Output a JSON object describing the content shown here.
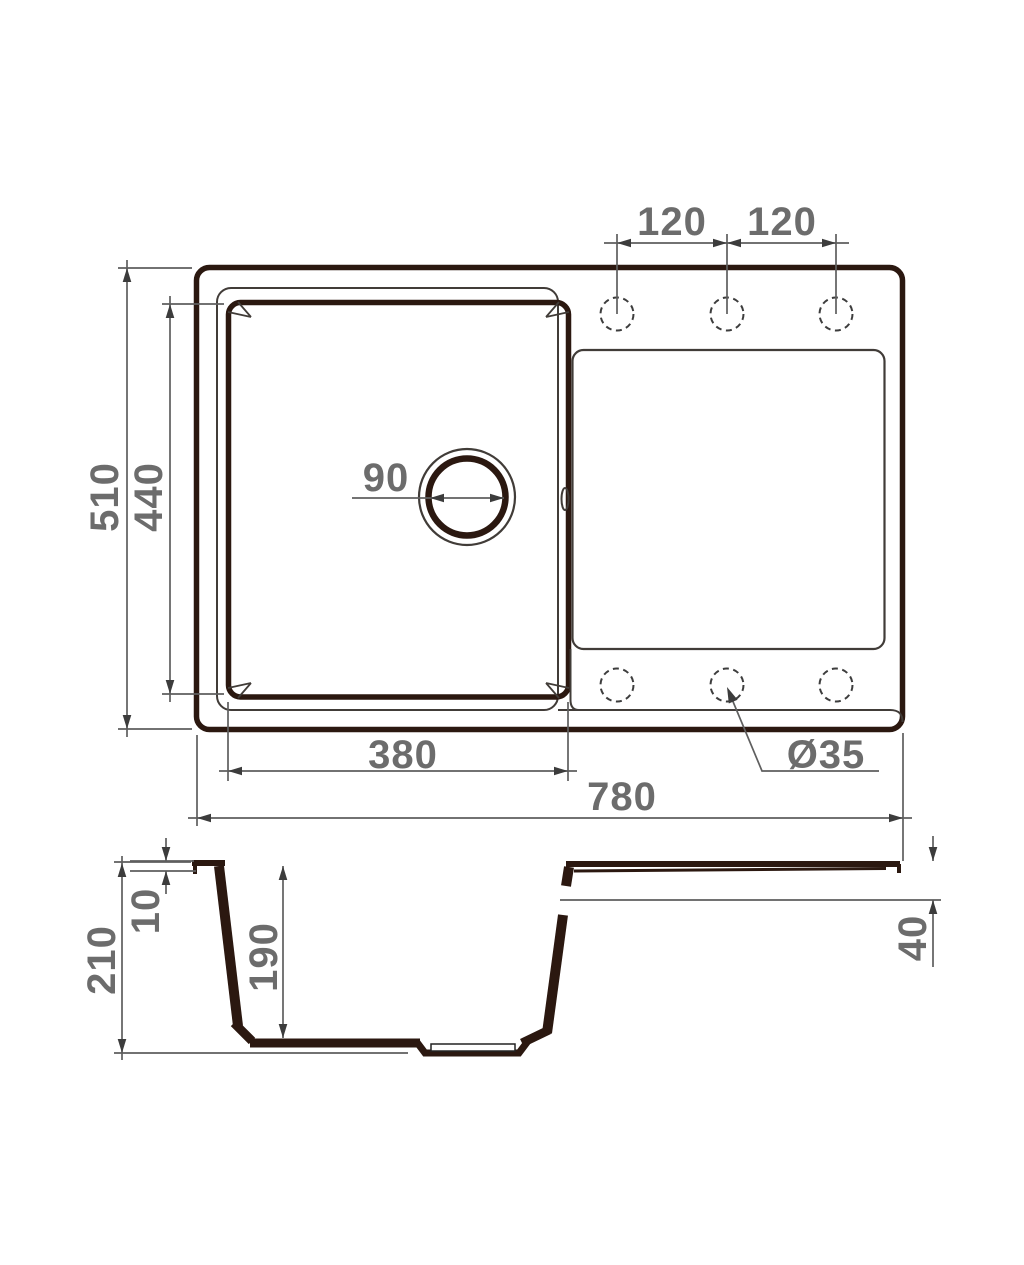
{
  "drawing": {
    "top_view": {
      "overall_width": "780",
      "overall_depth": "510",
      "bowl_width": "380",
      "bowl_depth": "440",
      "hole_spacing_left": "120",
      "hole_spacing_right": "120",
      "drain_diameter": "90",
      "faucet_hole_diameter": "Ø35"
    },
    "section_view": {
      "overall_height": "210",
      "rim_height": "10",
      "bowl_inner_depth": "190",
      "drainboard_edge_height": "40"
    },
    "colors": {
      "outline": "#2b1810",
      "thin_line": "#413c38",
      "dimension_line": "#5f5f5f",
      "label_text": "#6c6c6c",
      "background": "#ffffff"
    }
  }
}
